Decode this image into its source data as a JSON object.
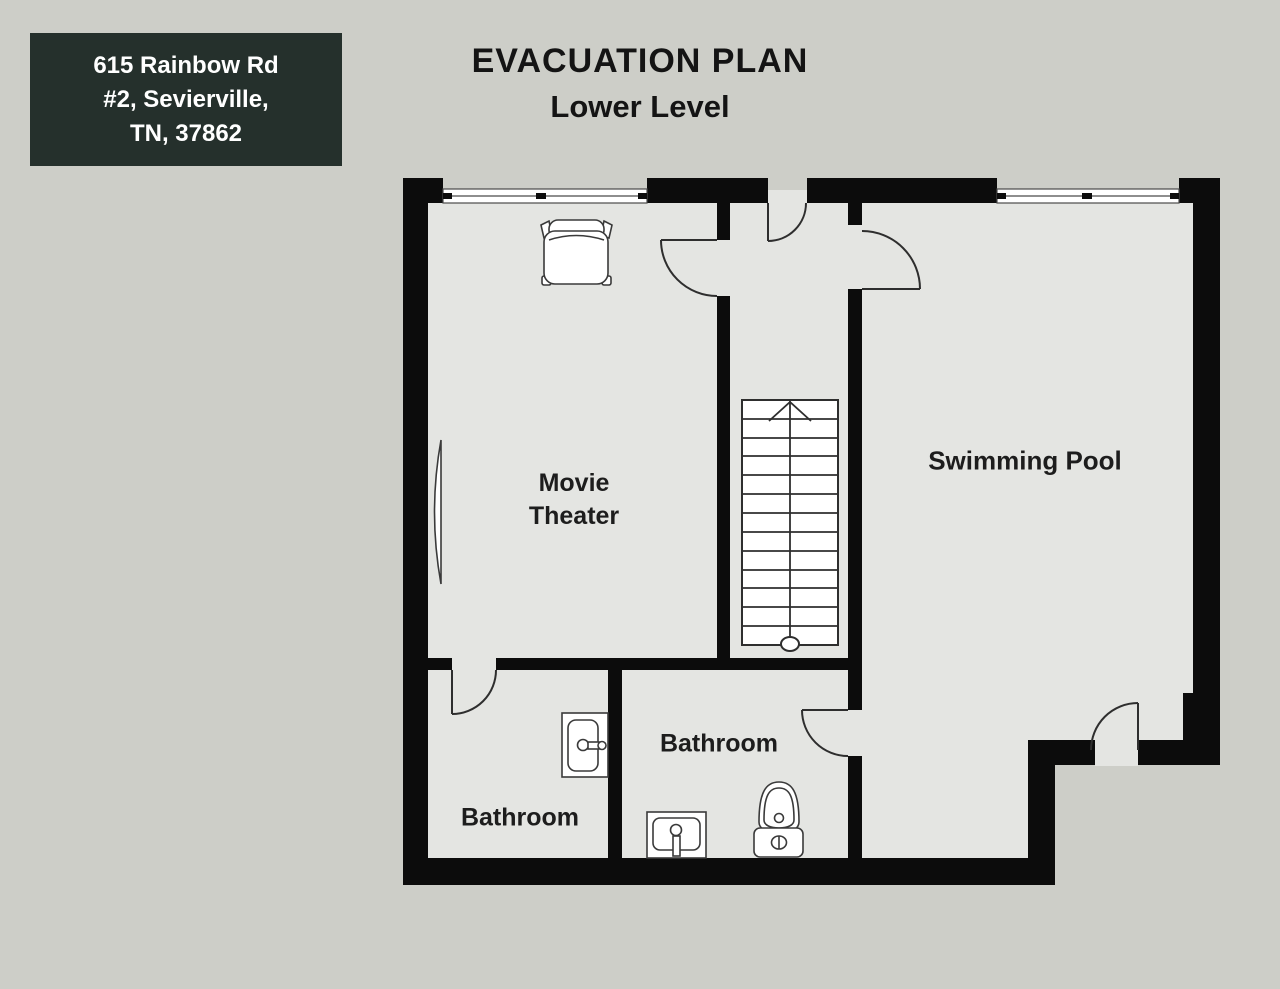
{
  "address_box": {
    "line1": "615 Rainbow Rd",
    "line2": "#2, Sevierville,",
    "line3": "TN, 37862"
  },
  "title": {
    "heading": "EVACUATION PLAN",
    "subheading": "Lower Level"
  },
  "rooms": {
    "movie_theater": {
      "line1": "Movie",
      "line2": "Theater"
    },
    "swimming_pool": {
      "label": "Swimming Pool"
    },
    "bathroom_middle": {
      "label": "Bathroom"
    },
    "bathroom_left": {
      "label": "Bathroom"
    }
  },
  "fixtures": [
    "sofa",
    "projector-screen",
    "staircase-up",
    "vanity-sink",
    "vanity-sink",
    "toilet"
  ],
  "counts": {
    "doors": 6,
    "windows": 2
  },
  "colors": {
    "background": "#cdcec8",
    "floor": "#e4e5e2",
    "wall": "#0c0c0c",
    "line": "#2e2e2e",
    "address_bg": "#25302c",
    "address_text": "#ffffff",
    "label_text": "#1d1d1d"
  }
}
